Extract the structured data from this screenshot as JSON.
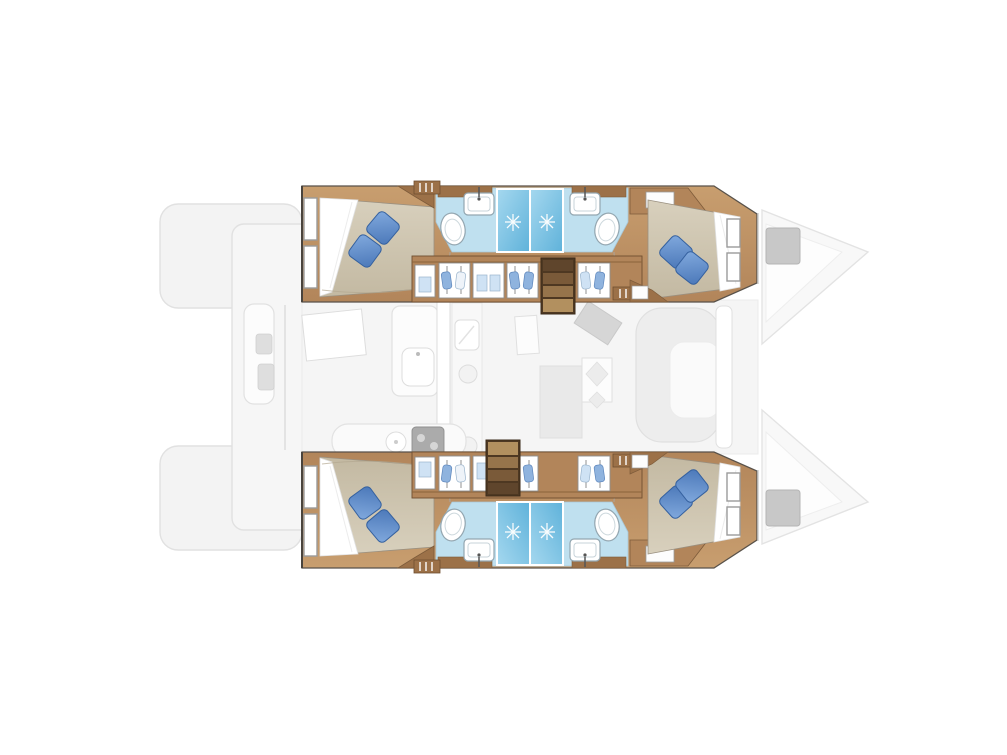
{
  "page": {
    "title": "Catamaran yacht interior floor plan",
    "view": "overhead (top-down) layout drawing",
    "background": "#ffffff",
    "visible_text": []
  },
  "palette": {
    "wood": "#b2855a",
    "wood_light": "#c89e6f",
    "wood_dark": "#9c7148",
    "wood_trim": "#7d5b3a",
    "stair_deep": "#5f452c",
    "stair_mid1": "#7a5a39",
    "stair_mid2": "#96744b",
    "stair_entry": "#b2905f",
    "duvet_light": "#d8d0bd",
    "duvet_dark": "#c3b9a2",
    "sheet_white": "#ffffff",
    "pillow_light": "#82aade",
    "pillow_dark": "#4a77b8",
    "pillow_edge": "#35619f",
    "bath_floor": "#bfe0ef",
    "shower_light": "#a5d8ef",
    "shower_deep": "#5fb2da",
    "fixture_white": "#ffffff",
    "fixture_outline": "#93a6b0",
    "pane_blue": "#cfe2f4",
    "garment_blue": "#8fb3de",
    "ghost_fill": "#f3f3f3",
    "ghost_stroke": "#e1e1e1",
    "ghost_dark": "#dedede",
    "hatch_gray": "#c8c8c8",
    "hull_outline": "#59524a",
    "window_frame": "#9b9b9b"
  },
  "floorplan": {
    "vessel_type": "sailing catamaran",
    "layout_summary": {
      "double_cabins": 4,
      "bathrooms": 4,
      "shower_cubicles": 4,
      "companionway_stairs": 2
    },
    "bridgedeck": {
      "state": "ghosted outline",
      "areas": [
        {
          "name": "aft cockpit",
          "features": [
            "transom steps port",
            "transom steps starboard",
            "aft deck",
            "cockpit bench"
          ]
        },
        {
          "name": "saloon and galley",
          "features": [
            "galley counter",
            "galley sink",
            "stove burners",
            "appliance",
            "dinette table",
            "chart seat",
            "wrap-around sofa",
            "sliding door panel"
          ]
        },
        {
          "name": "bows",
          "features": [
            "port bow with deck hatch",
            "starboard bow with deck hatch"
          ]
        }
      ]
    },
    "hulls": [
      {
        "name": "hull (top of plan)",
        "rooms": [
          {
            "name": "aft double cabin",
            "furniture": [
              "island double berth",
              "white sheet",
              "2 blue cushions",
              "2 hull windows",
              "overhead locker"
            ]
          },
          {
            "name": "aft bathroom",
            "fixtures": [
              "washbasin with faucet",
              "toilet",
              "shower cubicle with glass"
            ]
          },
          {
            "name": "forward bathroom",
            "fixtures": [
              "washbasin with faucet",
              "toilet",
              "shower cubicle with glass"
            ]
          },
          {
            "name": "companionway corridor",
            "furniture": [
              "wardrobe lockers with hanging clothes",
              "locker doors with blue panes",
              "vent grilles",
              "staircase to saloon"
            ]
          },
          {
            "name": "forward double cabin",
            "furniture": [
              "island double berth",
              "white sheet",
              "2 blue cushions",
              "2 hull windows",
              "forward locker"
            ]
          }
        ]
      },
      {
        "name": "hull (bottom of plan)",
        "rooms": [
          {
            "name": "aft double cabin",
            "furniture": [
              "island double berth",
              "white sheet",
              "2 blue cushions",
              "2 hull windows",
              "overhead locker"
            ]
          },
          {
            "name": "aft bathroom",
            "fixtures": [
              "washbasin with faucet",
              "toilet",
              "shower cubicle with glass"
            ]
          },
          {
            "name": "forward bathroom",
            "fixtures": [
              "washbasin with faucet",
              "toilet",
              "shower cubicle with glass"
            ]
          },
          {
            "name": "companionway corridor",
            "furniture": [
              "wardrobe lockers with hanging clothes",
              "locker doors with blue panes",
              "vent grilles",
              "staircase to saloon"
            ]
          },
          {
            "name": "forward double cabin",
            "furniture": [
              "island double berth",
              "white sheet",
              "2 blue cushions",
              "2 hull windows",
              "forward locker"
            ]
          }
        ]
      }
    ],
    "icons": {
      "shower_sparkle": "white 8-ray star on blue shower floor",
      "hanging_clothes": "blue garments on hangers inside wardrobe",
      "faucet": "dark stem with dot on washbasin",
      "deck_hatch": "gray square on bow deck"
    }
  }
}
